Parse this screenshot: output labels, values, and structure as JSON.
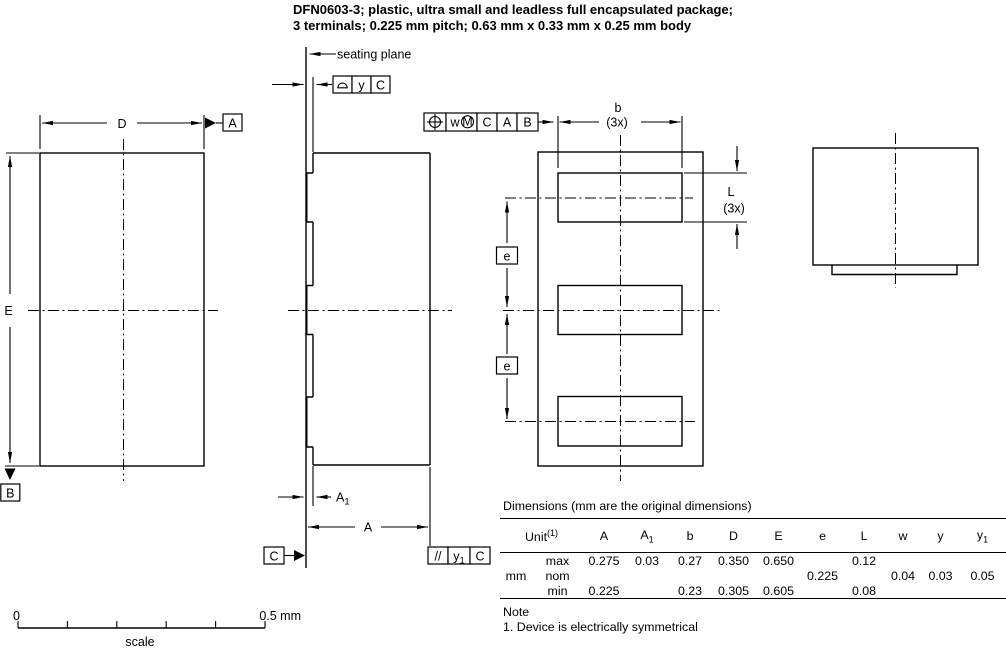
{
  "title": {
    "line1": "DFN0603-3; plastic, ultra small and leadless full encapsulated package;",
    "line2": "3 terminals; 0.225 mm pitch; 0.63 mm x 0.33 mm x 0.25 mm body"
  },
  "drawing": {
    "seating_plane": "seating plane",
    "datum_a": "A",
    "datum_b": "B",
    "datum_c": "C",
    "dim_d": "D",
    "dim_e_side": "E",
    "dim_a": "A",
    "dim_a1_base": "A",
    "dim_a1_sub": "1",
    "dim_b": "b",
    "count_3x": "(3x)",
    "dim_l": "L",
    "dim_e_pitch": "e",
    "frame_flat": {
      "tol": "y",
      "datum": "C"
    },
    "frame_pos": {
      "tol": "w",
      "mod": "M",
      "d1": "C",
      "d2": "A",
      "d3": "B"
    },
    "frame_par": {
      "sym": "//",
      "tol_base": "y",
      "tol_sub": "1",
      "datum": "C"
    },
    "line_color": "#000000",
    "background": "#ffffff"
  },
  "scalebar": {
    "zero": "0",
    "max": "0.5 mm",
    "label": "scale"
  },
  "table": {
    "title": "Dimensions (mm are the original dimensions)",
    "unit_label": "Unit",
    "unit_sup": "(1)",
    "col_a": "A",
    "col_a1_base": "A",
    "col_a1_sub": "1",
    "col_b": "b",
    "col_d": "D",
    "col_e": "E",
    "col_e2": "e",
    "col_l": "L",
    "col_w": "w",
    "col_y": "y",
    "col_y1_base": "y",
    "col_y1_sub": "1",
    "unit_value": "mm",
    "rows": [
      {
        "label": "max",
        "values": [
          "0.275",
          "0.03",
          "0.27",
          "0.350",
          "0.650",
          "",
          "0.12",
          "",
          "",
          ""
        ]
      },
      {
        "label": "nom",
        "values": [
          "",
          "",
          "",
          "",
          "",
          "0.225",
          "",
          "0.04",
          "0.03",
          "0.05"
        ]
      },
      {
        "label": "min",
        "values": [
          "0.225",
          "",
          "0.23",
          "0.305",
          "0.605",
          "",
          "0.08",
          "",
          "",
          ""
        ]
      }
    ],
    "note_title": "Note",
    "note_1": "1. Device is electrically symmetrical"
  }
}
